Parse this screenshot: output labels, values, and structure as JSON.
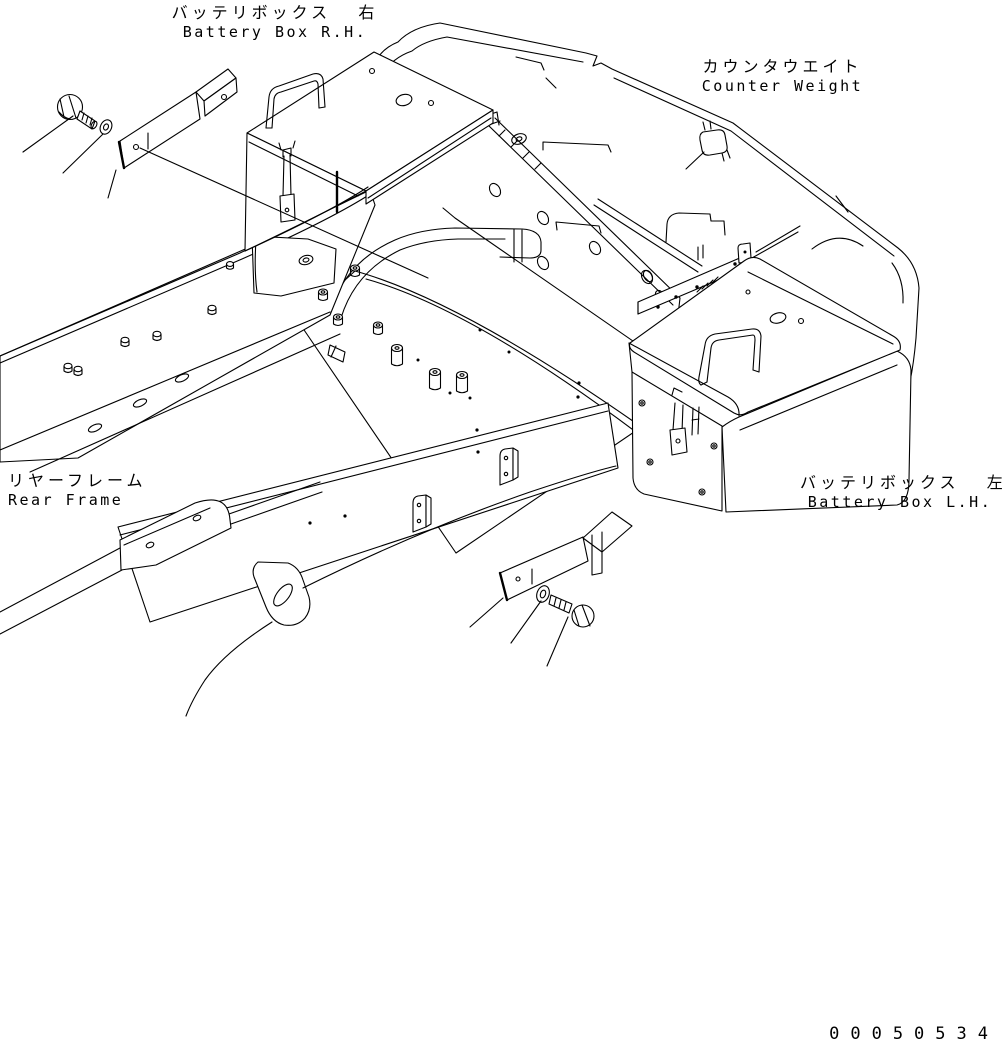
{
  "page": {
    "background": "#ffffff",
    "line_color": "#000000"
  },
  "labels": {
    "battery_box_rh": {
      "jp": "バッテリボックス  右",
      "en": "Battery Box R.H."
    },
    "counter_weight": {
      "jp": "カウンタウエイト",
      "en": "Counter Weight"
    },
    "rear_frame": {
      "jp": "リヤーフレーム",
      "en": "Rear Frame"
    },
    "battery_box_lh": {
      "jp": "バッテリボックス  左",
      "en": "Battery Box L.H."
    },
    "drawing_number": "00050534"
  },
  "parts_shown": [
    "counterweight",
    "rear-frame",
    "battery-box-right",
    "battery-box-left",
    "mounting-bracket-upper",
    "mounting-bracket-lower",
    "bolt-upper",
    "washer-upper",
    "bolt-lower",
    "washer-lower",
    "tow-hook",
    "battery-hold-latch"
  ]
}
